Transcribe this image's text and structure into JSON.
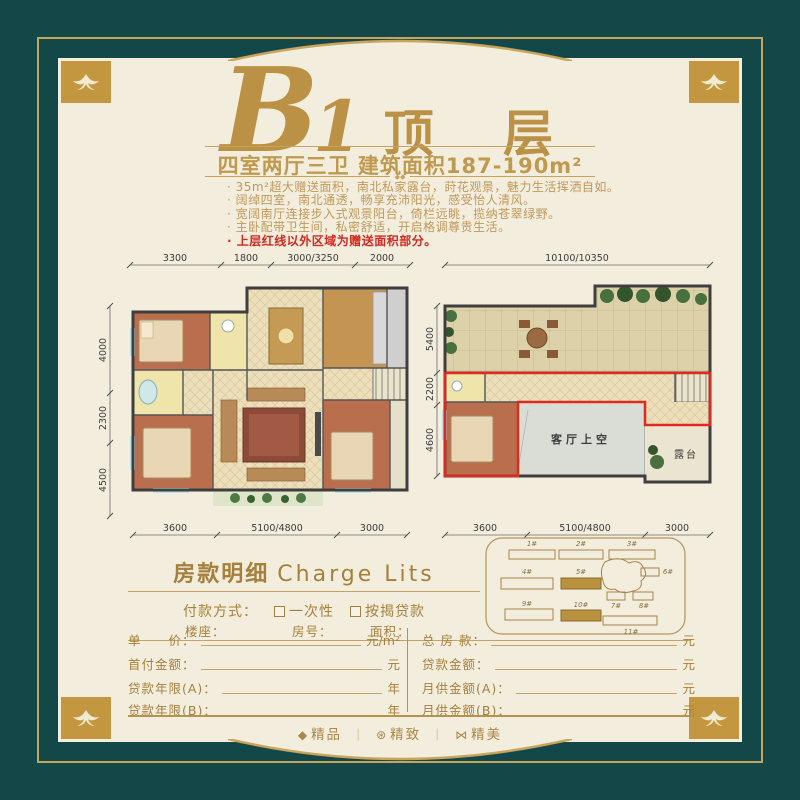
{
  "title": {
    "letter": "B",
    "numeral": "1",
    "suffix": "顶 层",
    "subtitle": "四室两厅三卫  建筑面积187-190m²",
    "ornament": "◆◆"
  },
  "features": {
    "items": [
      {
        "text": "· 35m²超大赠送面积，南北私家露台，莳花观景，魅力生活挥洒自如。",
        "highlight": false
      },
      {
        "text": "· 阔绰四室，南北通透，畅享充沛阳光，感受怡人清风。",
        "highlight": false
      },
      {
        "text": "· 宽阔南厅连接步入式观景阳台，倚栏远眺，揽纳苍翠绿野。",
        "highlight": false
      },
      {
        "text": "· 主卧配带卫生间，私密舒适，开启格调尊贵生活。",
        "highlight": false
      },
      {
        "text": "· 上层红线以外区域为赠送面积部分。",
        "highlight": true
      }
    ]
  },
  "floorplan_left": {
    "dims_top": [
      "3300",
      "1800",
      "3000/3250",
      "2000"
    ],
    "dims_left": [
      "4000",
      "2300",
      "4500"
    ],
    "dims_bottom": [
      "3600",
      "5100/4800",
      "3000"
    ]
  },
  "floorplan_right": {
    "dim_top": "10100/10350",
    "dims_left": [
      "5400",
      "2200",
      "4600"
    ],
    "dims_bottom": [
      "3600",
      "5100/4800",
      "3000"
    ],
    "label_void": "客厅上空",
    "label_terrace": "露台"
  },
  "siteplan": {
    "buildings": [
      {
        "label": "1#",
        "highlighted": false
      },
      {
        "label": "2#",
        "highlighted": false
      },
      {
        "label": "3#",
        "highlighted": false
      },
      {
        "label": "4#",
        "highlighted": false
      },
      {
        "label": "5#",
        "highlighted": true
      },
      {
        "label": "6#",
        "highlighted": false
      },
      {
        "label": "7#",
        "highlighted": false
      },
      {
        "label": "8#",
        "highlighted": false
      },
      {
        "label": "9#",
        "highlighted": false
      },
      {
        "label": "10#",
        "highlighted": true
      },
      {
        "label": "11#",
        "highlighted": false
      }
    ]
  },
  "payment": {
    "heading_cn": "房款明细",
    "heading_en": "Charge Lits",
    "method_label": "付款方式：",
    "methods": [
      "一次性",
      "按揭贷款"
    ],
    "info": [
      "楼座：",
      "房号：",
      "面积："
    ],
    "left_rows": [
      {
        "label": "单　　价：",
        "unit": "元/m²"
      },
      {
        "label": "首付金额：",
        "unit": "元"
      },
      {
        "label": "贷款年限(A)：",
        "unit": "年"
      },
      {
        "label": "贷款年限(B)：",
        "unit": "年"
      }
    ],
    "right_rows": [
      {
        "label": "总 房 款：",
        "unit": "元"
      },
      {
        "label": "贷款金额：",
        "unit": "元"
      },
      {
        "label": "月供金额(A)：",
        "unit": "元"
      },
      {
        "label": "月供金额(B)：",
        "unit": "元"
      }
    ]
  },
  "footer": {
    "sep": "｜",
    "items": [
      {
        "icon": "◆",
        "label": "精品"
      },
      {
        "icon": "⊛",
        "label": "精致"
      },
      {
        "icon": "⋈",
        "label": "精美"
      }
    ]
  },
  "colors": {
    "teal": "#144748",
    "gold": "#c9a45c",
    "cream": "#f2eddd",
    "title_gold": "#bb9146",
    "red_line": "#e02a1e"
  }
}
